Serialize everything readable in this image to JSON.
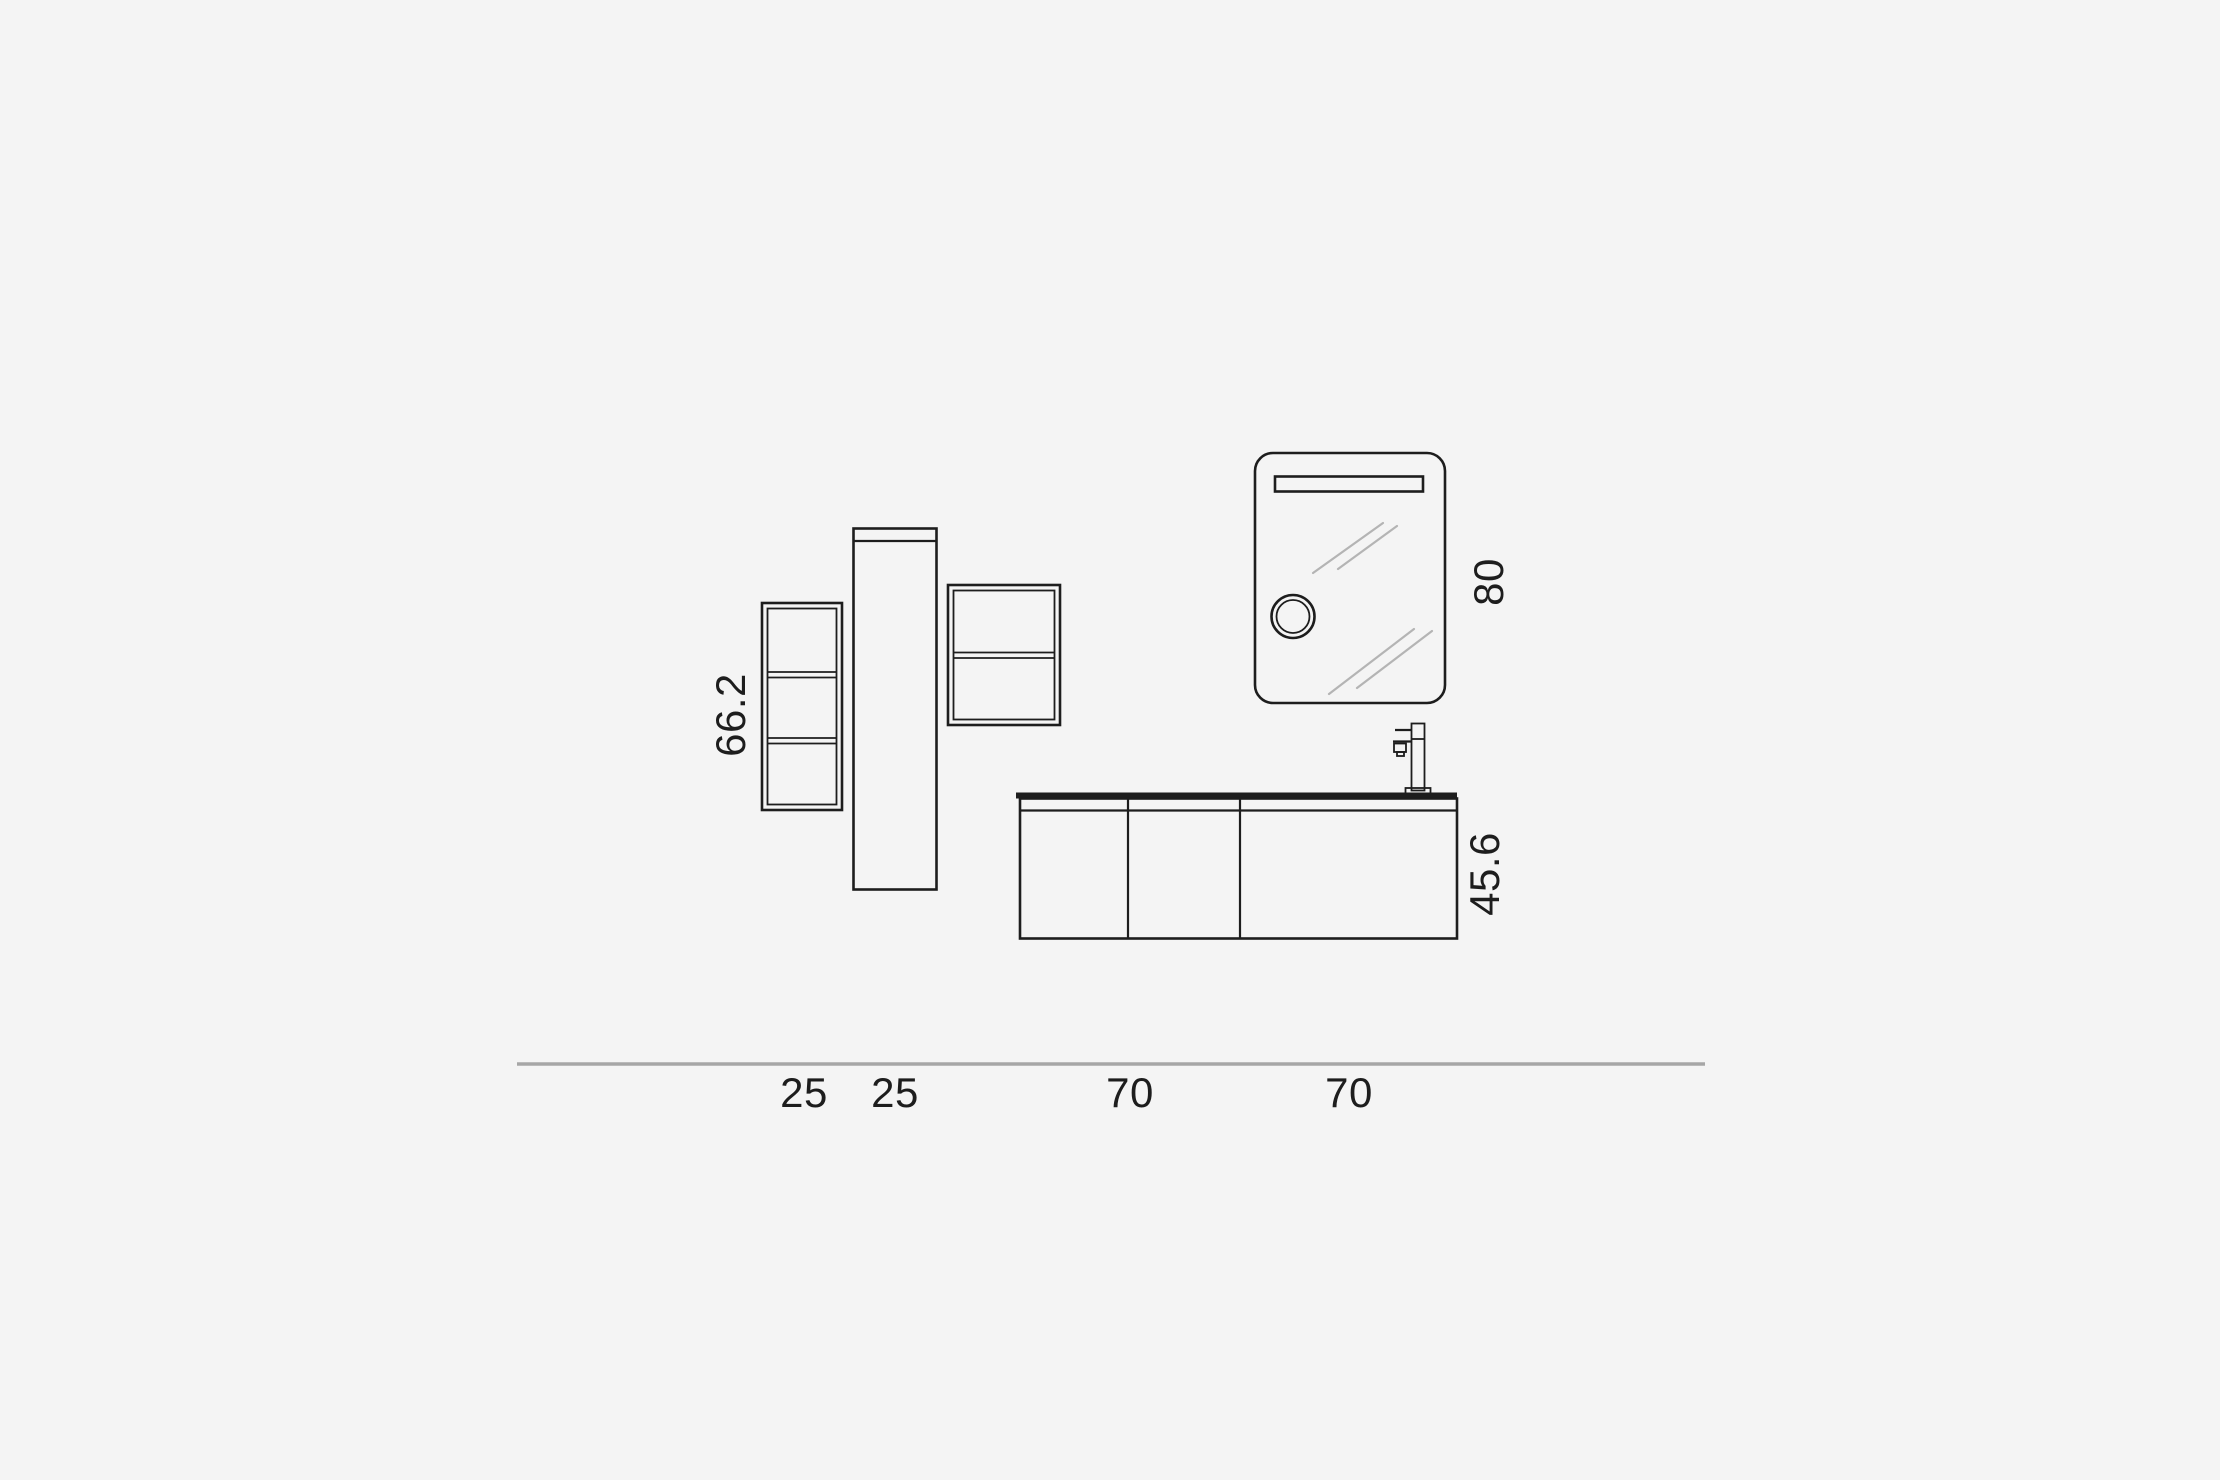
{
  "diagram": {
    "colors": {
      "background": "#f4f4f4",
      "line": "#1d1d1d",
      "ground": "#a6a6a6",
      "hatch": "#b4b4b4",
      "text": "#1d1d1d"
    },
    "labels": {
      "shelf_unit_height": "66.2",
      "mirror_height": "80",
      "vanity_height": "45.6",
      "width_1": "25",
      "width_2": "25",
      "width_3": "70",
      "width_4": "70"
    }
  }
}
